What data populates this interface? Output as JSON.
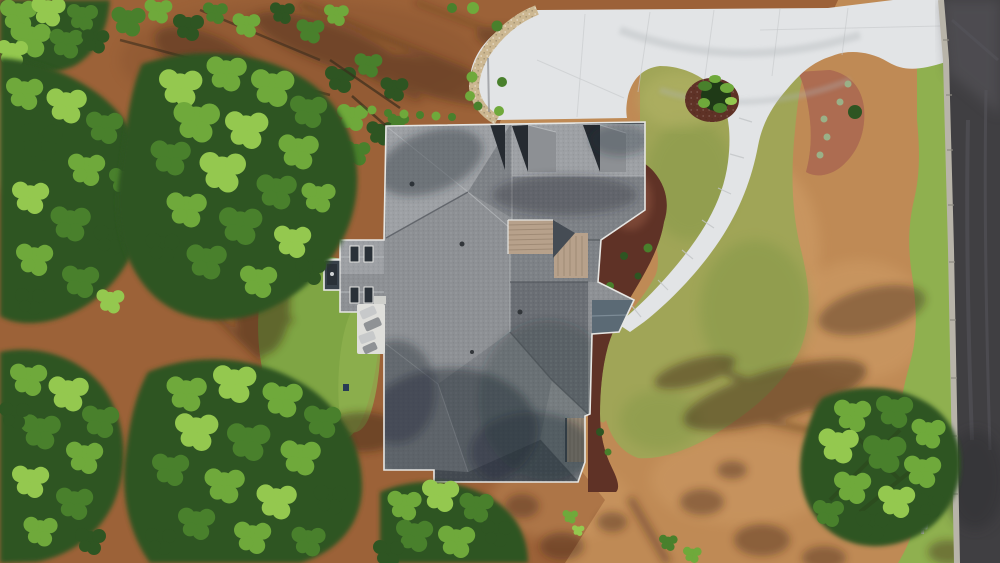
{
  "meta": {
    "title": "Aerial drone view of a new house on a wooded pine lot",
    "view": "top-down overhead photograph",
    "dimensions": "1000x563"
  },
  "labels": {
    "scene": "Overhead aerial photo of a gray-shingle roof house surrounded by pine trees, lawn, dirt yard, concrete driveway and a street",
    "pine-straw-ground": "reddish pine straw forest floor on the left half",
    "dirt-yard": "tan bare-dirt yard on the right half",
    "tree-shadows": "long pine tree shadows cast on the ground",
    "front-lawn": "kidney shaped sodded front lawn",
    "grass-island": "grass island enclosed by driveway and walkway",
    "left-yard-grass": "small grass yard beside the patio",
    "road-strip-grass": "narrow grass strip along the street curb",
    "mulch-bed-house": "dark red mulch planting bed wrapping the right side of the house",
    "mulch-bed-crescent": "crescent mulch bed with small plants beside the driveway",
    "planting-bed-top": "mulch bed with shrubs above the house",
    "gravel-border": "river-stone border along the driveway edge",
    "driveway-apron": "broad white concrete driveway apron",
    "walkway": "curved concrete walkway sweeping to the front entry",
    "road": "asphalt street along the right edge",
    "curb": "concrete curb and gutter",
    "mailbox": "small white mailbox at the curb",
    "house-roof": "complex hip-and-gable architectural shingle roof",
    "dormers": "hip dormers with shaded window recesses",
    "metal-roof-panel-upper": "tan standing-seam metal roof over the entry",
    "metal-roof-panel-lower": "small tan metal awning roof",
    "bay-window-roof": "slate colored bay window roof",
    "left-wing": "left wing roof with dormer windows",
    "skylights": "dark dormer window panes",
    "cupola": "small dark cupola with white trim",
    "patio": "white patio with lounge chairs",
    "island-tree": "small ornamental tree in a mulch ring",
    "pine-canopy-left": "dense pine and hardwood canopy on the left",
    "pine-canopy-bottom-right": "single pine canopy overhanging the street"
  },
  "colors": {
    "bg-tan": "#bf8a55",
    "dirt-light": "#d4a36c",
    "straw": "#9c6238",
    "straw-dark": "#7a4a29",
    "shadow-ground": "#402813",
    "concrete": "#e2e4e6",
    "concrete-streak": "#c6c9cb",
    "gravel": "#ccb791",
    "lawn": "#a0a557",
    "lawn-dark": "#7f9544",
    "lawn-light": "#b4b466",
    "lawn-strip": "#8fb04f",
    "grass-left": "#7fa544",
    "mulch-dark": "#5f3226",
    "mulch-red": "#ad6d52",
    "road": "#403f42",
    "road-light": "#59575c",
    "curb": "#b8b4a9",
    "roof-light": "#9da0a4",
    "roof-mid": "#8d9094",
    "roof-mid2": "#7d8186",
    "roof-dark": "#6a6e74",
    "roof-darkest": "#5d6167",
    "roof-shadow": "#232d38",
    "dormer-dark": "#262b31",
    "trim": "#e6e6e3",
    "metal-tan": "#b7a18b",
    "metal-tan2": "#9d8873",
    "slate": "#5b6a75",
    "window-dark": "#2a3138",
    "patio": "#dfdfdb",
    "chair-light": "#c7c9ca",
    "chair-dark": "#8f9295",
    "green1": "#1f3a17",
    "green2": "#2e5522",
    "green3": "#49802c",
    "green4": "#6fa93b",
    "green5": "#94c84f",
    "green6": "#a8d45f",
    "branch": "#4a3420"
  }
}
